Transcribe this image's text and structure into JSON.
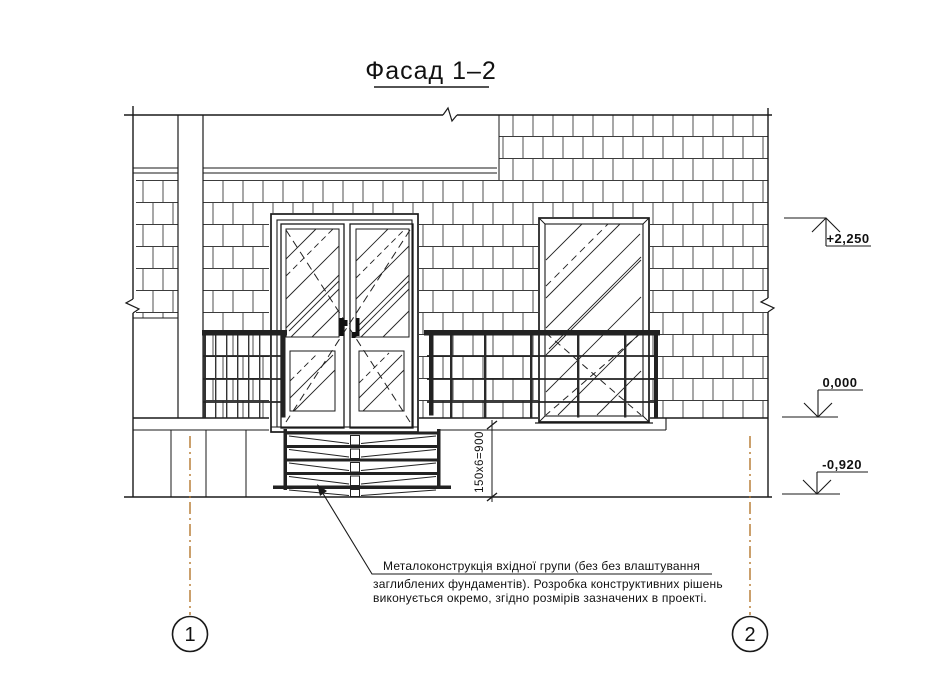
{
  "title": "Фасад 1–2",
  "drawing_type": "facade-elevation",
  "colors": {
    "line": "#1a1a1a",
    "brick_line": "#3c3c3c",
    "axis_line": "#b5772e",
    "background": "#ffffff"
  },
  "elevations": [
    {
      "label": "+2,250"
    },
    {
      "label": "0,000"
    },
    {
      "label": "-0,920"
    }
  ],
  "dimensions": {
    "stair_height": "150х6=900"
  },
  "axes": [
    {
      "label": "1"
    },
    {
      "label": "2"
    }
  ],
  "note": {
    "lines": [
      "Металоконструкція вхідної групи (без без влаштування",
      "заглиблених фундаментів). Розробка конструктивних рішень",
      "виконується окремо, згідно розмірів зазначених в проекті."
    ]
  }
}
